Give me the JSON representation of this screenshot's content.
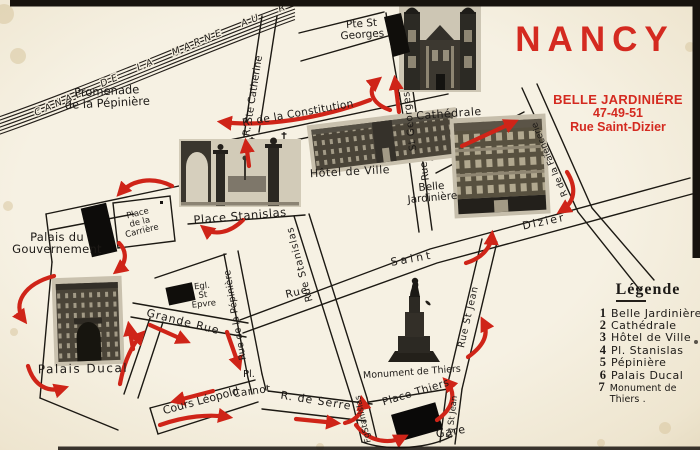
{
  "postcard": {
    "city_title": "NANCY",
    "shop_name": "BELLE JARDINIÉRE",
    "shop_numbers": "47-49-51",
    "shop_street": "Rue Saint-Dizier",
    "colors": {
      "accent_red": "#d42a20",
      "arrow_red": "#cf2418",
      "paper": "#f3eddd",
      "ink": "#1d1a17"
    }
  },
  "legend": {
    "title": "Légende",
    "items": [
      {
        "num": "1",
        "label": "Belle Jardinière"
      },
      {
        "num": "2",
        "label": "Cathédrale"
      },
      {
        "num": "3",
        "label": "Hôtel de Ville"
      },
      {
        "num": "4",
        "label": "Pl. Stanislas"
      },
      {
        "num": "5",
        "label": "Pépinière"
      },
      {
        "num": "6",
        "label": "Palais Ducal"
      },
      {
        "num": "7",
        "label": "Monument de Thiers ."
      }
    ]
  },
  "map_labels": {
    "canal": "CANAL  DE  LA  MARNE  AU  RHIN",
    "promenade_line1": "Promenade",
    "promenade_line2": "de la Pépinière",
    "rue_ste_catherine": "R. Ste Catherine",
    "pte_st_georges_line1": "Pte St",
    "pte_st_georges_line2": "Georges",
    "rue_constitution": "R. de la Constitution",
    "cathedrale": "Cathédrale",
    "hotel_de_ville": "Hôtel de Ville",
    "rue_st_georges": "St Georges",
    "rue_st_georges_rue": "Rue",
    "belle_jardiniere_line1": "Belle",
    "belle_jardiniere_line2": "Jardinière",
    "place_stanislas": "Place Stanislas",
    "place_carriere_line1": "Place",
    "place_carriere_line2": "de la",
    "place_carriere_line3": "Carrière",
    "palais_gouvernement_line1": "Palais du",
    "palais_gouvernement_line2": "Gouvernement",
    "eglise_line1": "Egl.",
    "eglise_line2": "St",
    "eglise_line3": "Epvre",
    "grande_rue": "Grande Rue",
    "rue_pepiniere": "Rue de la Pépinière",
    "rue_stanislas": "Rue  Stanislas",
    "rue_saint": "Saint",
    "rue_saint_rue": "Rue",
    "rue_dizier": "Dizier",
    "rue_faiencerie": "R de la Faïencerie",
    "rue_st_jean": "Rue  St  Jean",
    "palais_ducal": "Palais Ducal",
    "monument_thiers": "Monument de Thiers",
    "place_thiers": "Place Thiers",
    "gare": "Gare",
    "fg_stanislas": "FgStanislas",
    "fg_st_jean": "Fg St Jean",
    "pl_carnot_line1": "Pl.",
    "pl_carnot_line2": "Carnot",
    "cours_leopold": "Cours  Léopold",
    "rue_de_serre": "R. de Serre"
  }
}
